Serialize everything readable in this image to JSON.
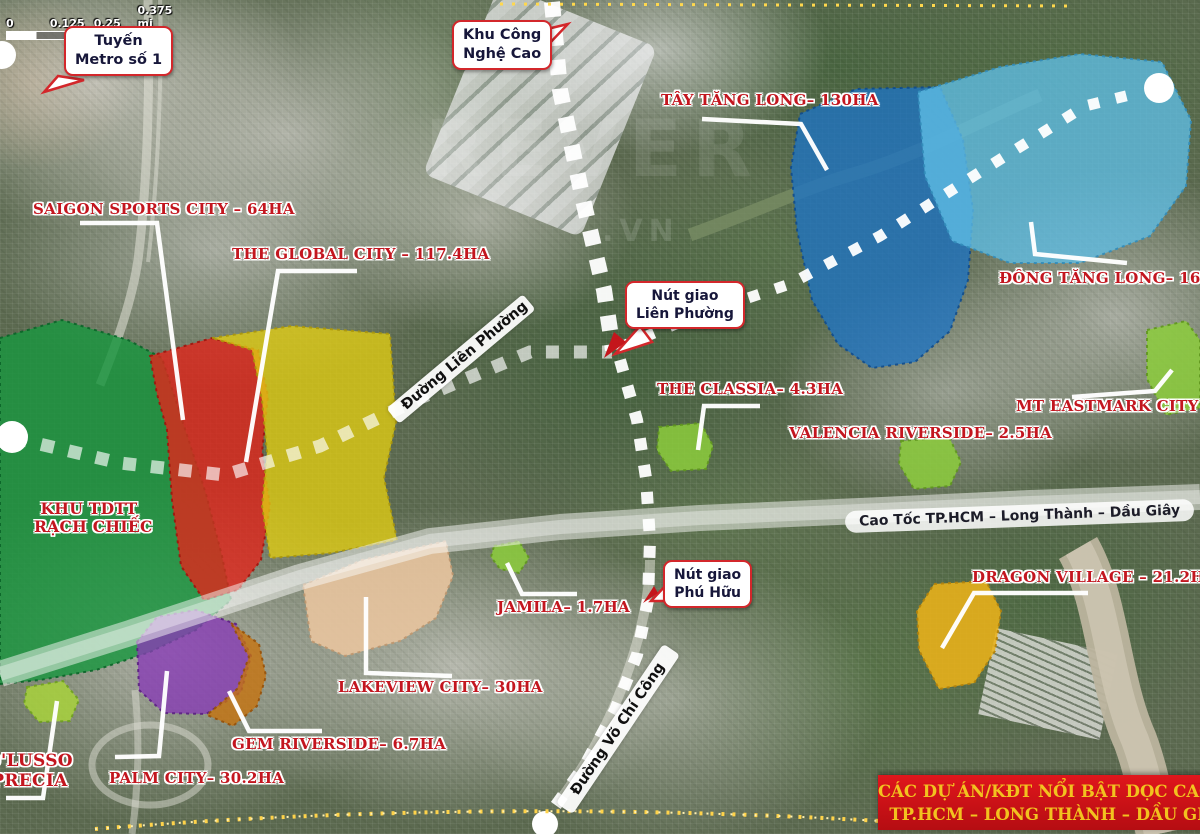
{
  "scale_bar": {
    "ticks": [
      "0",
      "0.125",
      "0.25",
      "0.375 mi"
    ]
  },
  "watermark": {
    "line1": "REVER",
    "line2": ".VN"
  },
  "callouts": {
    "metro_line1": {
      "line1": "Tuyến",
      "line2": "Metro số 1"
    },
    "hi_tech_park": {
      "line1": "Khu Công",
      "line2": "Nghệ Cao"
    },
    "lien_phuong_junction": {
      "line1": "Nút giao",
      "line2": "Liên Phường"
    },
    "phu_huu_junction": {
      "line1": "Nút giao",
      "line2": "Phú Hữu"
    }
  },
  "road_labels": {
    "lien_phuong": "Đường Liên Phường",
    "vo_chi_cong": "Đường Võ Chí Công",
    "highway": "Cao Tốc TP.HCM – Long Thành – Dầu Giây"
  },
  "zone_label": {
    "line1": "KHU TDTT",
    "line2": "RẠCH CHIẾC",
    "overlay_color": "#1a9640"
  },
  "projects": {
    "saigon_sports_city": {
      "label": "SAIGON SPORTS CITY – 64HA",
      "overlay_color": "#e1251b"
    },
    "the_global_city": {
      "label": "THE GLOBAL CITY – 117.4HA",
      "overlay_color": "#e2cd12"
    },
    "tay_tang_long": {
      "label": "TÂY TĂNG LONG– 130HA",
      "overlay_color": "#1e73c3"
    },
    "dong_tang_long": {
      "label": "ĐÔNG TĂNG LONG– 160HA",
      "overlay_color": "#5fbee6"
    },
    "mt_eastmark_city": {
      "label": "MT EASTMARK CITY ~20HA",
      "overlay_color": "#8ccd3c"
    },
    "the_classia": {
      "label": "THE CLASSIA– 4.3HA",
      "overlay_color": "#8ccd3c"
    },
    "valencia_riverside": {
      "label": "VALENCIA RIVERSIDE– 2.5HA",
      "overlay_color": "#8ccd3c"
    },
    "jamila": {
      "label": "JAMILA– 1.7HA",
      "overlay_color": "#8ccd3c"
    },
    "lakeview_city": {
      "label": "LAKEVIEW CITY– 30HA",
      "overlay_color": "#e8c49e"
    },
    "dragon_village": {
      "label": "DRAGON VILLAGE – 21.2HA",
      "overlay_color": "#ebb219"
    },
    "gem_riverside": {
      "label": "GEM RIVERSIDE– 6.7HA",
      "overlay_color": "#c6730f"
    },
    "palm_city": {
      "label": "PALM CITY– 30.2HA",
      "overlay_color": "#873cb4"
    },
    "dlusso_precia": {
      "line1": "D'LUSSO",
      "line2": "PRECIA",
      "overlay_color": "#a8d23c"
    }
  },
  "banner": {
    "line1": "CÁC DỰ ÁN/KĐT NỔI BẬT DỌC CAO TỐC",
    "line2": "TP.HCM – LONG THÀNH – DẦU GIÂY",
    "bg_color": "#cd1016",
    "text_color": "#f2c21f"
  },
  "label_text_color": "#c3161f"
}
